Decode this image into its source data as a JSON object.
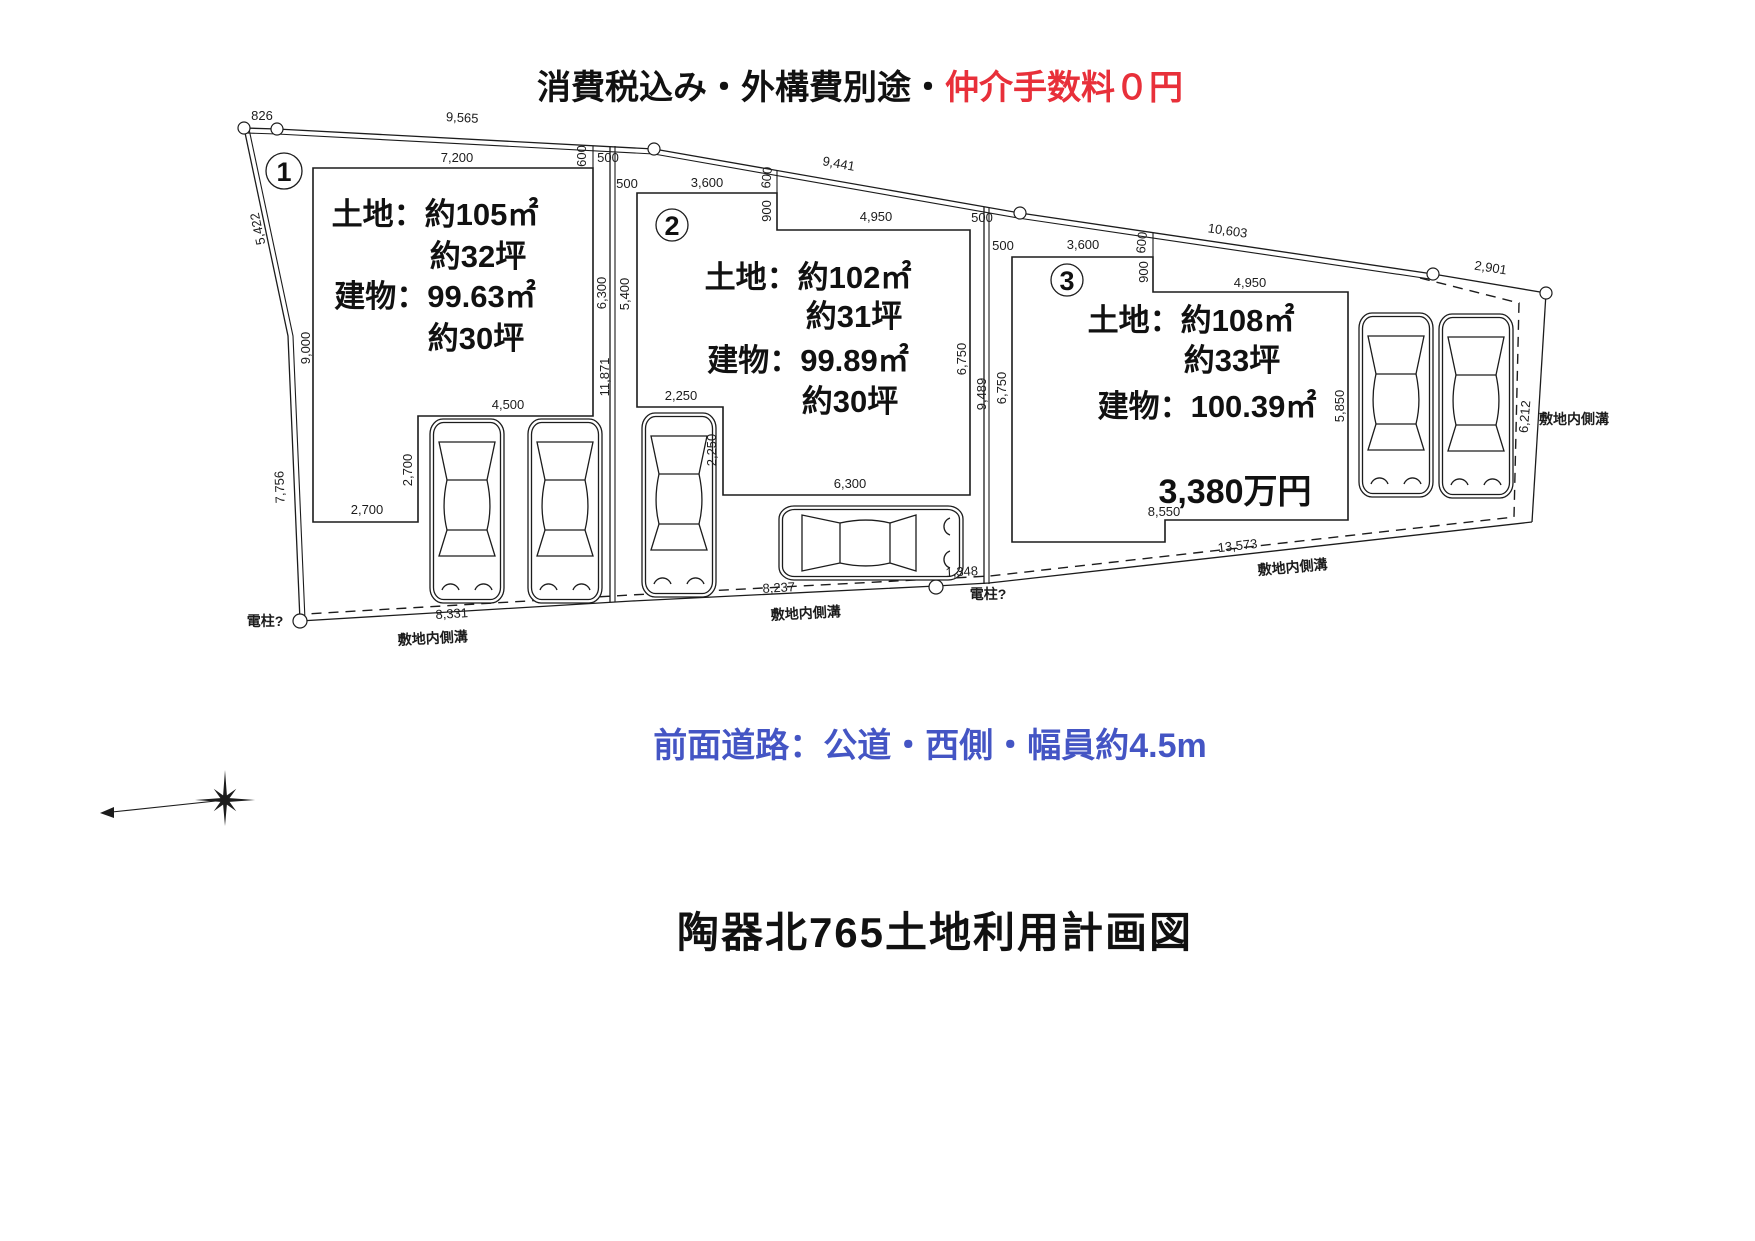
{
  "header": {
    "black": "消費税込み・外構費別途・",
    "red": "仲介手数料０円"
  },
  "road_note": "前面道路：公道・西側・幅員約4.5m",
  "title": "陶器北765土地利用計画図",
  "colors": {
    "red": "#e8303a",
    "blue": "#4455c4",
    "ink": "#111111"
  },
  "plots": [
    {
      "number": "1",
      "lines": [
        "土地：約105㎡",
        "約32坪",
        "建物：99.63㎡",
        "約30坪"
      ]
    },
    {
      "number": "2",
      "lines": [
        "土地：約102㎡",
        "約31坪",
        "建物：99.89㎡",
        "約30坪"
      ]
    },
    {
      "number": "3",
      "lines": [
        "土地：約108㎡",
        "約33坪",
        "建物：100.39㎡"
      ],
      "price": "3,380万円"
    }
  ],
  "notes": {
    "pole": "電柱?",
    "gutter": "敷地内側溝"
  },
  "dims": {
    "top": [
      "826",
      "9,565",
      "9,441",
      "10,603",
      "2,901"
    ],
    "left": [
      "5,422",
      "7,756"
    ],
    "bottom": [
      "8,331",
      "8,237",
      "1,348",
      "13,573"
    ],
    "right_gutter": "6,212",
    "p1": [
      "7,200",
      "9,000",
      "6,300",
      "4,500",
      "2,700",
      "2,700"
    ],
    "b12": [
      "600",
      "500",
      "500",
      "11,871"
    ],
    "p2": [
      "3,600",
      "600",
      "900",
      "4,950",
      "5,400",
      "6,750",
      "2,250",
      "2,250",
      "6,300"
    ],
    "b23": [
      "500",
      "500",
      "9,489"
    ],
    "p3": [
      "3,600",
      "600",
      "900",
      "4,950",
      "6,750",
      "5,850",
      "8,550"
    ]
  }
}
